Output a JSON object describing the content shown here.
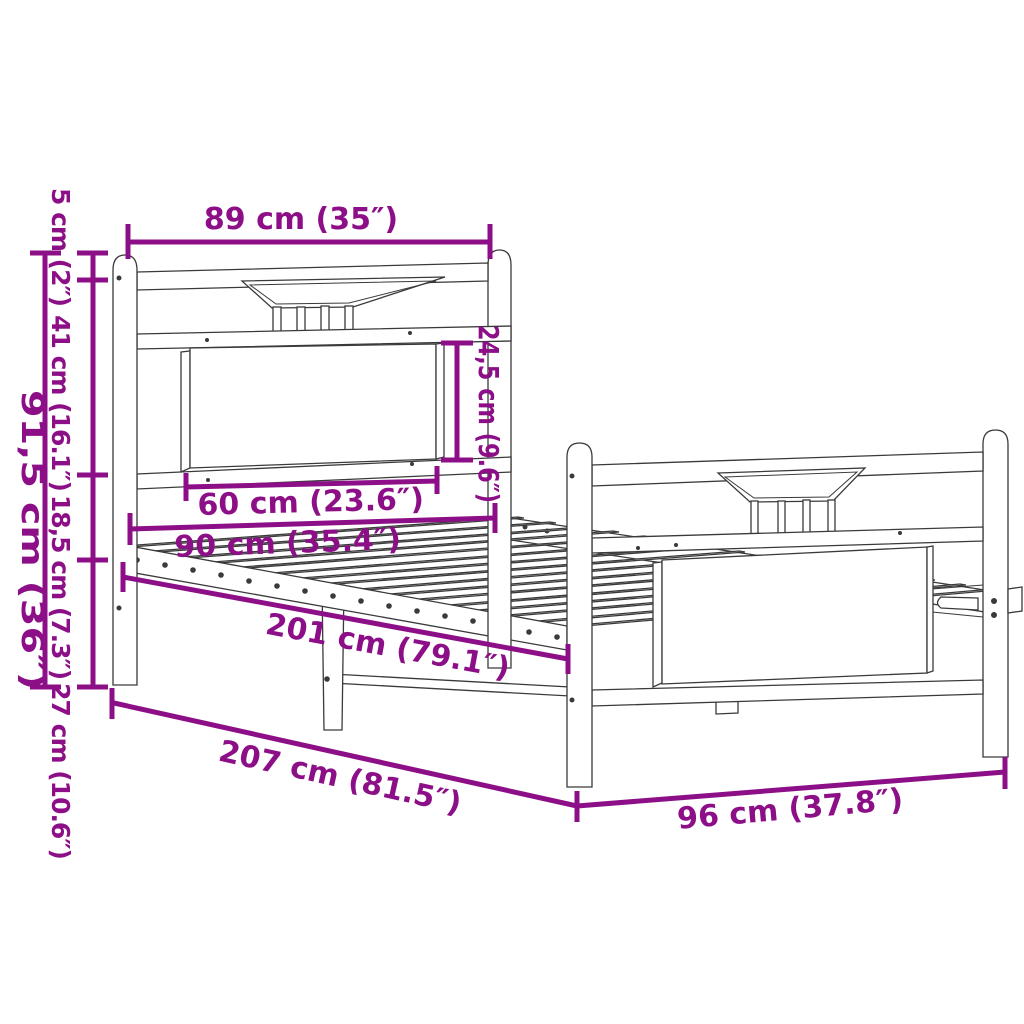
{
  "diagram": {
    "type": "product-dimension-diagram",
    "product": "metal-bed-frame-with-headboard-and-footboard",
    "background_color": "#ffffff",
    "dimension_color": "#8d0f88",
    "drawing_color": "#3a3a3a",
    "dimensions": {
      "headboard_width": "89 cm (35″)",
      "post_cap_height": "5 cm (2″)",
      "headboard_upper_height": "41 cm (16.1″)",
      "rail_to_base_height": "18,5 cm (7.3″)",
      "ground_clearance": "27 cm (10.6″)",
      "headboard_total_height": "91,5 cm (36″)",
      "headboard_panel_height": "24,5 cm (9.6″)",
      "headboard_panel_width": "60 cm (23.6″)",
      "mattress_width": "90 cm (35.4″)",
      "inner_length": "201 cm (79.1″)",
      "total_length": "207 cm (81.5″)",
      "total_width": "96 cm (37.8″)"
    }
  }
}
